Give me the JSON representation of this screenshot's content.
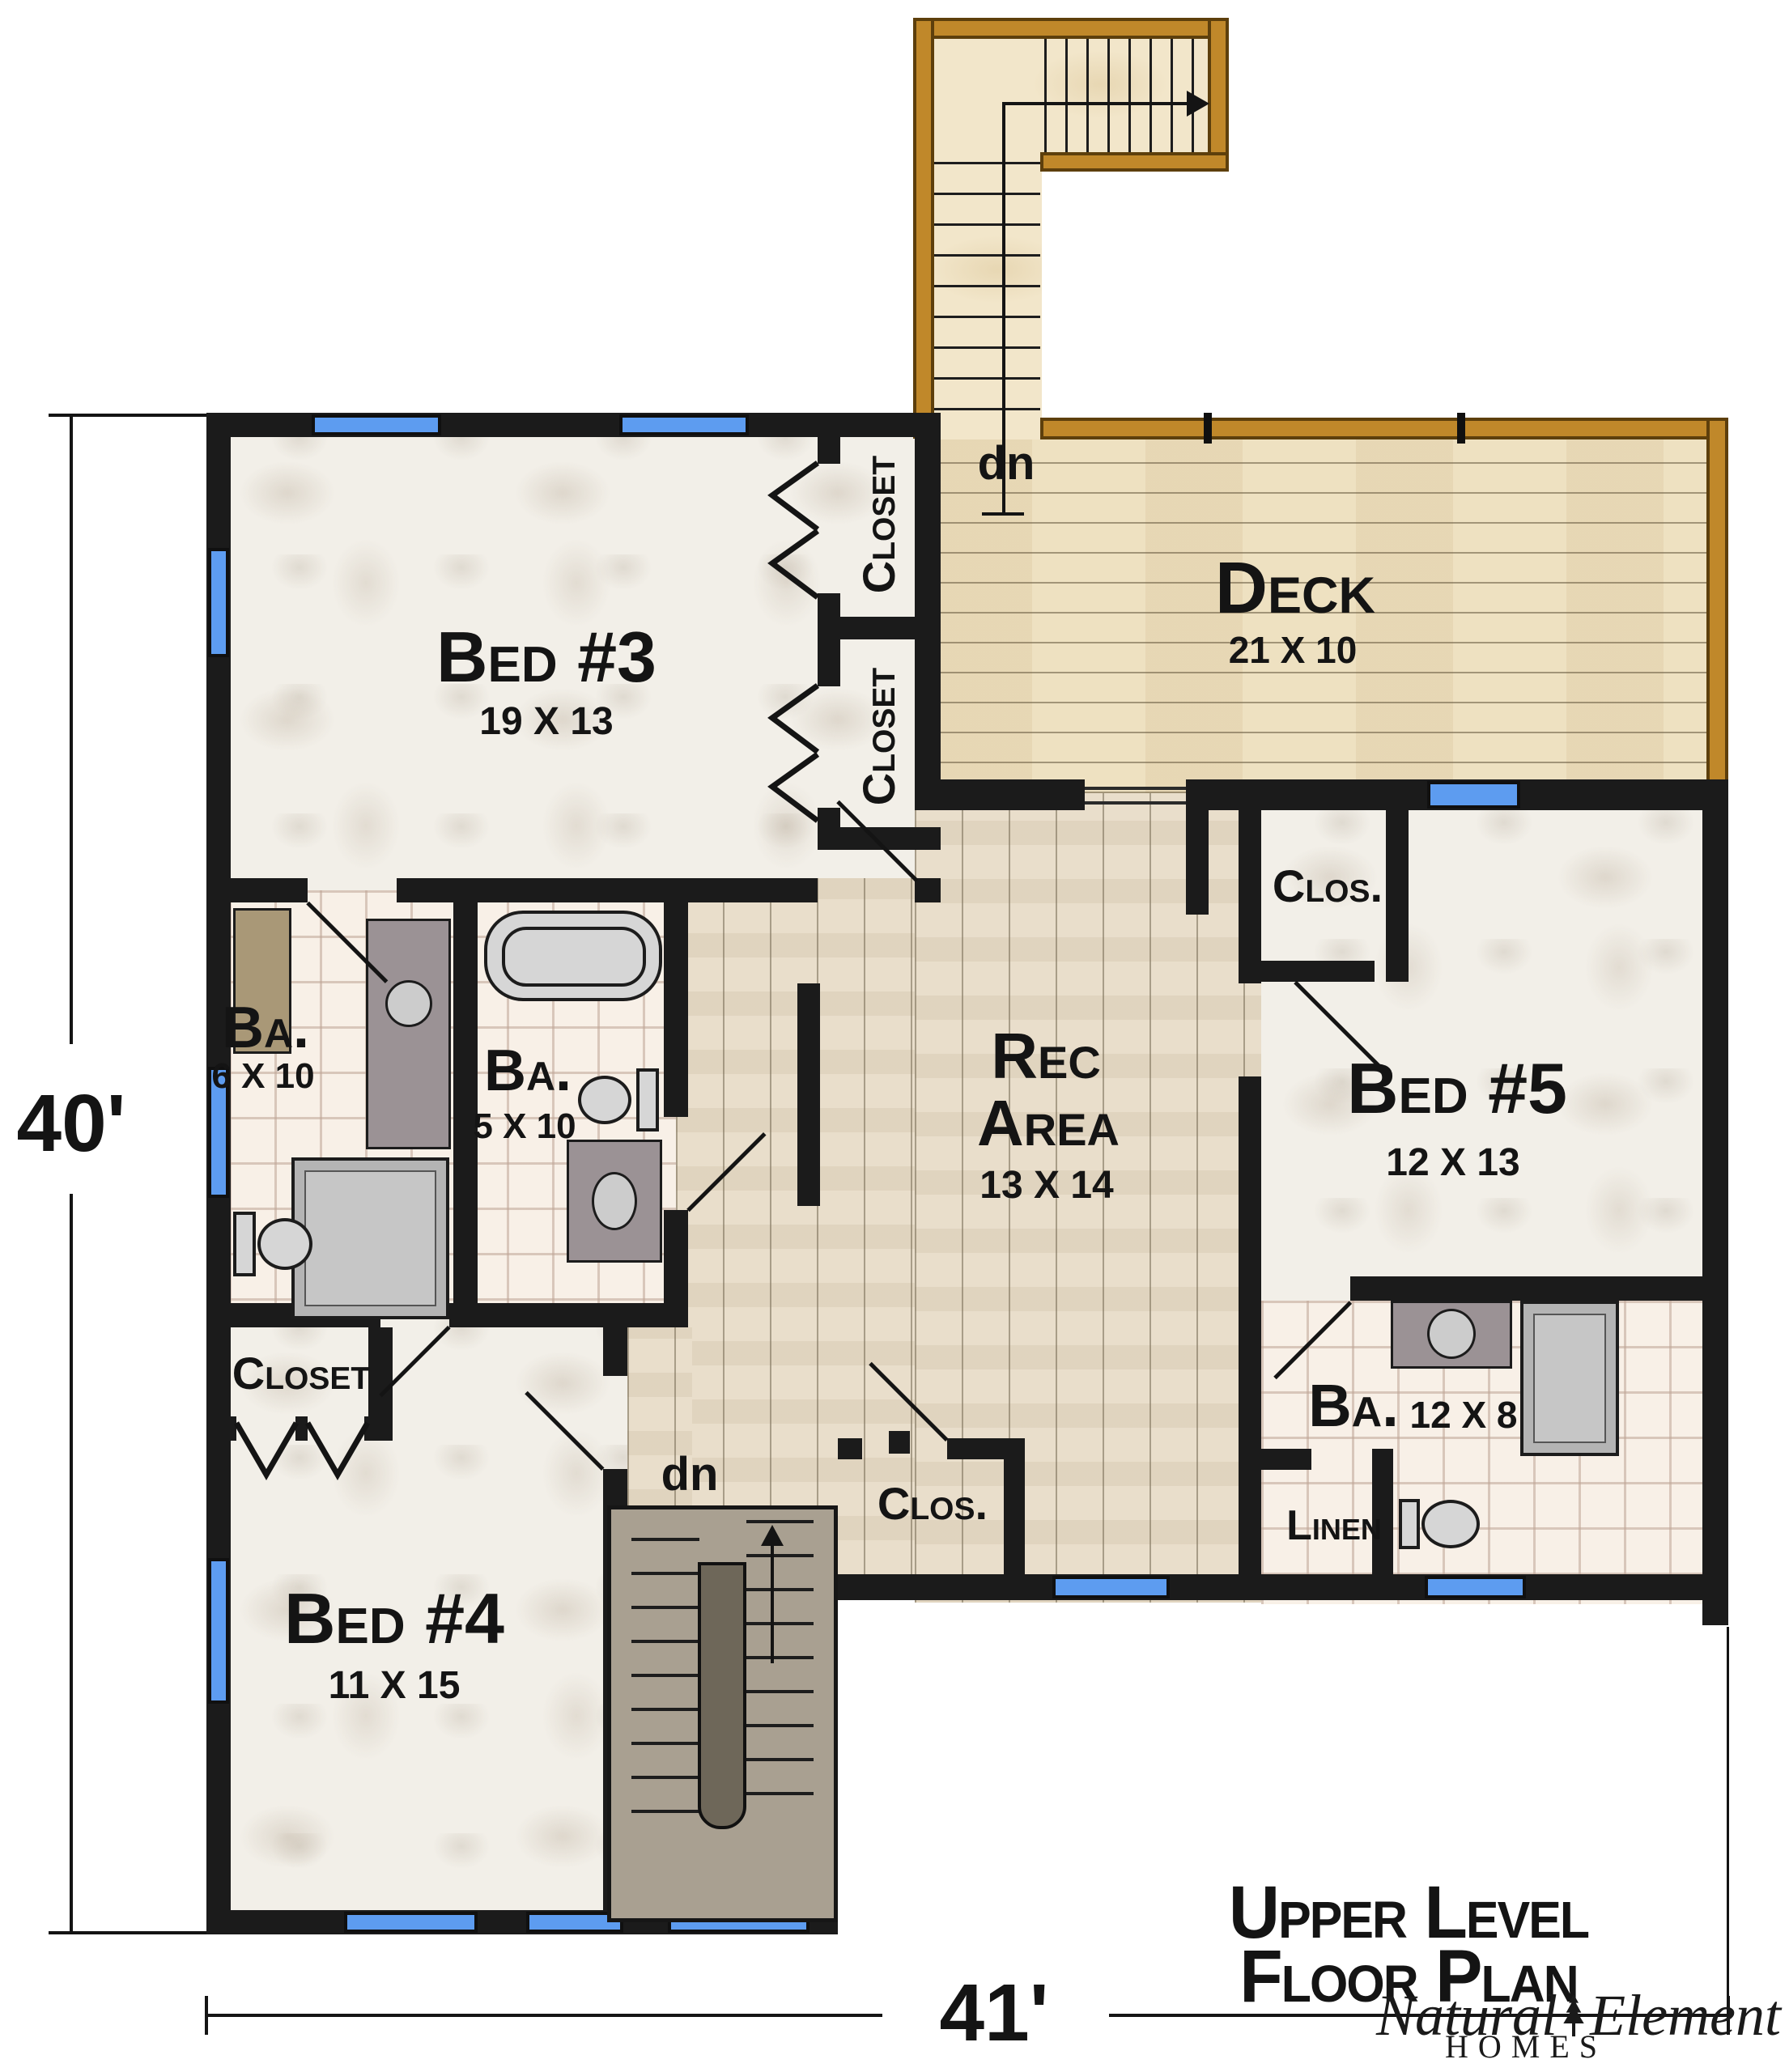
{
  "page": {
    "dim_left": "40'",
    "dim_bottom": "41'",
    "title": {
      "line1": "Upper Level",
      "line2": "Floor Plan"
    },
    "logo": {
      "script1": "Natural",
      "script2": "Element",
      "word": "HOMES"
    },
    "rooms": {
      "bed3": {
        "name": "Bed #3",
        "size": "19 X 13"
      },
      "bed4": {
        "name": "Bed #4",
        "size": "11 X 15"
      },
      "bed5": {
        "name": "Bed #5",
        "size": "12 X 13"
      },
      "rec": {
        "name1": "Rec",
        "name2": "Area",
        "size": "13 X 14"
      },
      "deck": {
        "name": "Deck",
        "size": "21 X 10"
      },
      "bath1": {
        "name": "Ba.",
        "size": "6 X 10"
      },
      "bath2": {
        "name": "Ba.",
        "size": "5 X 10"
      },
      "bath3": {
        "name": "Ba.",
        "size": "12 X 8"
      },
      "closet_upper": {
        "name": "Closet"
      },
      "closet_lower": {
        "name": "Closet"
      },
      "closet_bed4": {
        "name": "Closet"
      },
      "closet_bed5": {
        "name": "Clos."
      },
      "closet_rec": {
        "name": "Clos."
      },
      "linen": {
        "name": "Linen"
      }
    },
    "stairs": {
      "down_interior": "dn",
      "down_deck": "dn"
    }
  }
}
